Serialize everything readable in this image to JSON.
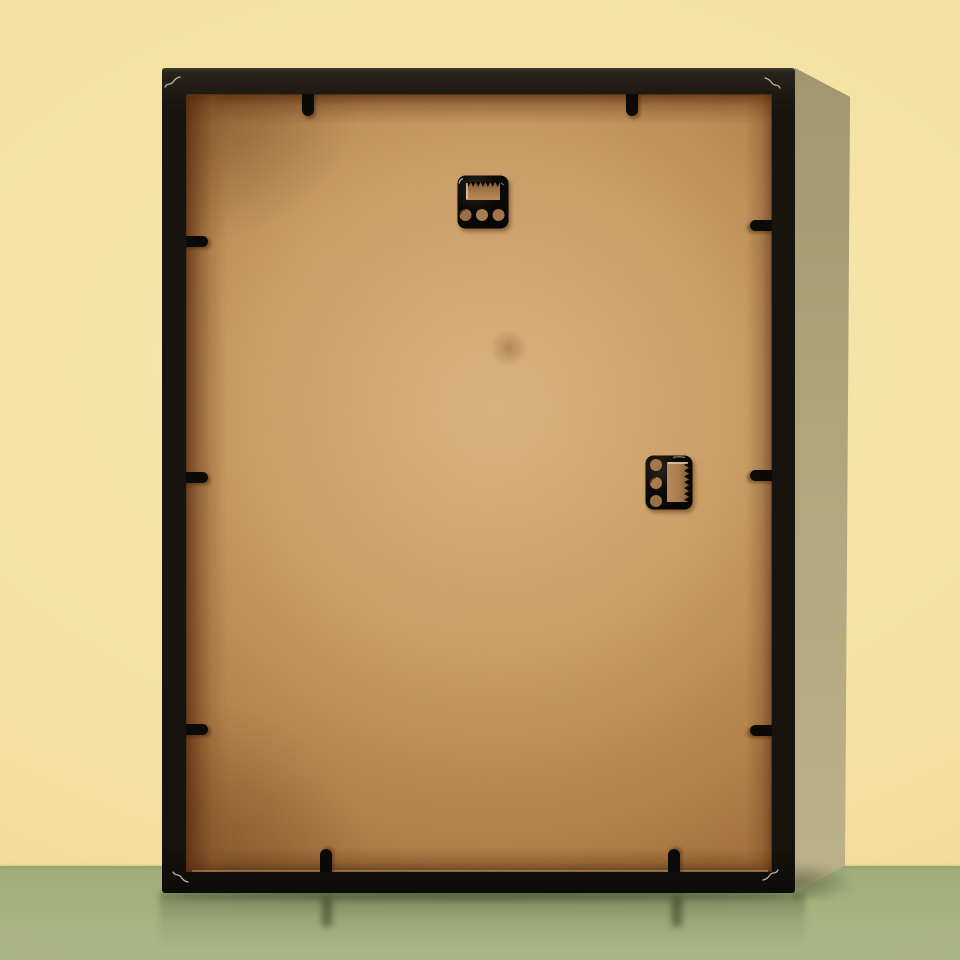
{
  "scene": {
    "type": "product-photo",
    "description": "Back view of a black rectangular picture frame leaning upright against a pale yellow wall, standing on a sage green glossy floor. The back shows a tan MDF backing board held by black plastic retainer clips, one horizontal sawtooth hanger near the top center and one vertical sawtooth hanger at the middle right. The frame casts a khaki shadow band on the wall to its right and a faint reflection on the floor below.",
    "objects": [
      "black picture frame (rear view)",
      "MDF backing board",
      "sawtooth hanger, landscape orientation",
      "sawtooth hanger, portrait orientation",
      "black retainer clips",
      "corner miter seam scratches",
      "wall shadow band",
      "floor reflection"
    ]
  },
  "hardware": {
    "top_hanger": {
      "label": "sawtooth hanger (landscape)",
      "holes": 3,
      "teeth_edge": "top edge of slot"
    },
    "side_hanger": {
      "label": "sawtooth hanger (portrait)",
      "holes": 3,
      "teeth_edge": "right edge of slot"
    },
    "clips": {
      "top": 2,
      "bottom": 2,
      "left": 3,
      "right": 3,
      "total": 10
    }
  },
  "colors": {
    "wall": "#f5e1a4",
    "wall-light": "#f7e6ae",
    "wall-edge": "#eed493",
    "floor": "#9fac77",
    "floor-bottom": "#abb583",
    "frame-black": "#17130e",
    "frame-hi": "#2a251c",
    "side-top": "#a1966c",
    "side-mid": "#b0a67a",
    "side-bottom": "#bcb18a",
    "backing-light": "#d6a876",
    "backing": "#ca9a62",
    "backing-dark": "#b5834c",
    "margin-brown": "#6f3d18",
    "hardware": "#0c0a07",
    "cutout-brown": "#a87c4e",
    "glint": "#efe9dc",
    "seam-mark": "#d5cfc0"
  }
}
